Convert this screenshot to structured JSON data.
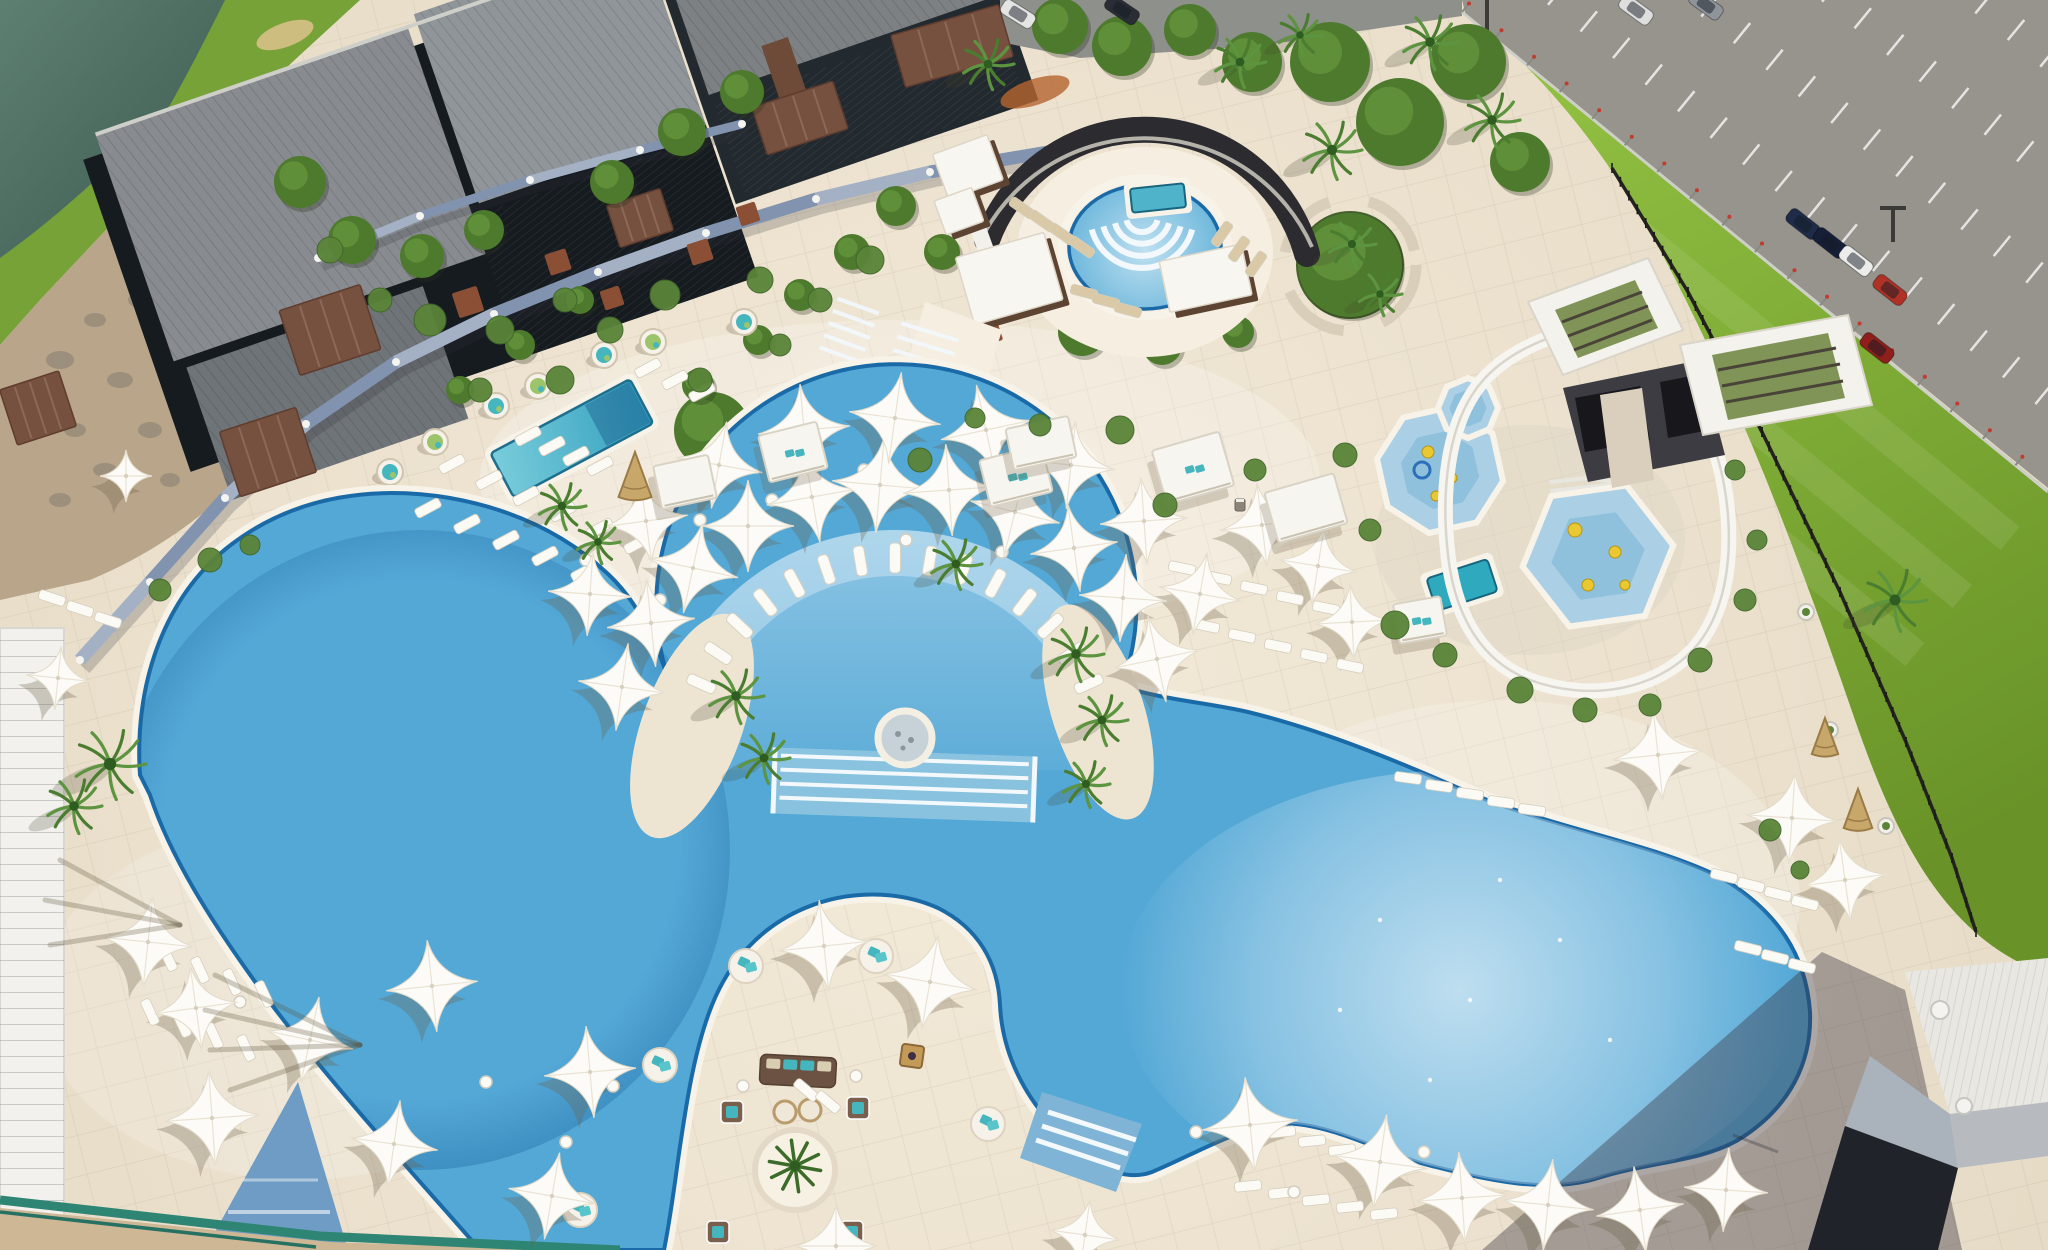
{
  "scene": {
    "title": "Aerial view of a resort pool complex with free-form swimming pools, white star shade umbrellas, water slide, splash pads, lawn and parking lot",
    "width": 2048,
    "height": 1250
  },
  "palette": {
    "deck": "#eee4d2",
    "deck_light": "#f6eee0",
    "water_base": "#54a8d6",
    "water_fan": "#a9d4ec",
    "water_shelf": "#bfe0ef",
    "pool_tile": "#1a6aa8",
    "coping": "#f8f3e8",
    "lake1": "#5d7f72",
    "lake2": "#39544a",
    "grass1": "#93c243",
    "grass2": "#699328",
    "parking_gray": "#96948d",
    "road_gray": "#8e908c",
    "roof1": "#888c90",
    "roof2": "#6f7478",
    "roof3": "#90959a",
    "glass": "#161b20",
    "wood": "#77513f",
    "fence_slate": "#8193af",
    "slide": "#f6f5f0",
    "tower_dark": "#3c3c42",
    "umbrella": "#fcfbf7",
    "umbrella_shadow": "rgba(110,96,72,0.30)",
    "lounger_white": "#fbfaf5",
    "lounger_tan": "#d9c9a7",
    "teal": "#45b6bd",
    "cushion_green": "#9cc46a",
    "pod_white": "#f6f2ea",
    "rust": "#8a4f35",
    "palm": "#4a7d2f",
    "palm_dark": "#2f5c20",
    "tree": "#4e7a2e",
    "shrub": "#5a8438",
    "rock": "#998e7b",
    "sand": "#cdb795",
    "rail_green": "#2f8573",
    "building_white": "#f2f1ed",
    "bldg_roof": "#e9e7e2",
    "bldg_dark": "#20242a",
    "shadow": "rgba(58,52,66,0.40)",
    "step_white": "#f2f8fb",
    "spa_inner": "#c6d2d8",
    "wicker": "#c8a76b",
    "fire": "#c49a58",
    "sofa": "#6b5243"
  },
  "umbrellas": [
    [
      622,
      687,
      44,
      8
    ],
    [
      651,
      623,
      44,
      -6
    ],
    [
      693,
      568,
      46,
      12
    ],
    [
      748,
      526,
      46,
      0
    ],
    [
      812,
      497,
      46,
      -10
    ],
    [
      880,
      485,
      48,
      5
    ],
    [
      949,
      490,
      46,
      -4
    ],
    [
      1015,
      512,
      46,
      14
    ],
    [
      1074,
      548,
      44,
      -8
    ],
    [
      1123,
      598,
      44,
      4
    ],
    [
      1157,
      659,
      44,
      -12
    ],
    [
      590,
      594,
      42,
      4
    ],
    [
      646,
      521,
      42,
      -8
    ],
    [
      719,
      465,
      44,
      10
    ],
    [
      804,
      430,
      46,
      -5
    ],
    [
      895,
      418,
      46,
      8
    ],
    [
      986,
      430,
      46,
      -12
    ],
    [
      1071,
      465,
      44,
      6
    ],
    [
      1144,
      521,
      44,
      -4
    ],
    [
      1200,
      594,
      42,
      10
    ],
    [
      1262,
      525,
      42,
      -7
    ],
    [
      1318,
      566,
      40,
      9
    ],
    [
      1352,
      622,
      38,
      -3
    ],
    [
      126,
      476,
      26,
      0
    ],
    [
      58,
      678,
      32,
      6
    ],
    [
      148,
      942,
      46,
      6
    ],
    [
      196,
      1008,
      42,
      -8
    ],
    [
      212,
      1118,
      48,
      -4
    ],
    [
      310,
      1040,
      44,
      12
    ],
    [
      432,
      986,
      46,
      -6
    ],
    [
      394,
      1144,
      44,
      8
    ],
    [
      590,
      1072,
      46,
      -5
    ],
    [
      552,
      1196,
      44,
      10
    ],
    [
      824,
      946,
      46,
      -6
    ],
    [
      930,
      982,
      48,
      10
    ],
    [
      836,
      1246,
      42,
      0
    ],
    [
      1085,
      1235,
      36,
      8
    ],
    [
      1250,
      1125,
      48,
      -6
    ],
    [
      1380,
      1162,
      48,
      8
    ],
    [
      1462,
      1198,
      46,
      -4
    ],
    [
      1548,
      1205,
      46,
      6
    ],
    [
      1640,
      1210,
      44,
      -8
    ],
    [
      1726,
      1190,
      42,
      4
    ],
    [
      1658,
      755,
      46,
      -6
    ],
    [
      1792,
      818,
      46,
      4
    ],
    [
      1845,
      880,
      42,
      -8
    ]
  ],
  "fan": {
    "cx": 895,
    "cy": 770,
    "r": 212,
    "a0": 204,
    "a1": 336,
    "n": 15
  },
  "lounger_rows": [
    [
      452,
      464,
      6,
      37,
      16,
      -28,
      "w"
    ],
    [
      428,
      508,
      5,
      39,
      16,
      -28,
      "w"
    ],
    [
      528,
      436,
      4,
      24,
      10,
      -28,
      "w"
    ],
    [
      648,
      368,
      3,
      27,
      12,
      -28,
      "w"
    ],
    [
      1022,
      208,
      4,
      20,
      13,
      35,
      "t"
    ],
    [
      1222,
      234,
      3,
      17,
      15,
      -55,
      "t"
    ],
    [
      1084,
      292,
      3,
      22,
      9,
      15,
      "t"
    ],
    [
      1182,
      568,
      5,
      36,
      10,
      12,
      "w"
    ],
    [
      1206,
      626,
      5,
      36,
      10,
      12,
      "w"
    ],
    [
      1724,
      876,
      4,
      27,
      9,
      14,
      "w"
    ],
    [
      1748,
      948,
      3,
      27,
      9,
      14,
      "w"
    ],
    [
      1408,
      778,
      5,
      31,
      8,
      8,
      "w"
    ],
    [
      1248,
      1186,
      5,
      34,
      7,
      -6,
      "w"
    ],
    [
      1282,
      1132,
      3,
      30,
      9,
      -6,
      "w"
    ],
    [
      168,
      958,
      4,
      32,
      12,
      65,
      "w"
    ],
    [
      150,
      1012,
      4,
      32,
      12,
      65,
      "w"
    ],
    [
      52,
      598,
      3,
      28,
      11,
      18,
      "w"
    ],
    [
      806,
      1090,
      2,
      22,
      12,
      40,
      "w"
    ]
  ],
  "pods": [
    [
      390,
      472,
      "t"
    ],
    [
      435,
      442,
      "g"
    ],
    [
      496,
      406,
      "t"
    ],
    [
      538,
      386,
      "g"
    ],
    [
      604,
      355,
      "t"
    ],
    [
      653,
      342,
      "g"
    ],
    [
      744,
      322,
      "t"
    ]
  ],
  "round_beds": [
    [
      660,
      1065
    ],
    [
      988,
      1124
    ],
    [
      580,
      1210
    ],
    [
      746,
      966
    ],
    [
      876,
      956
    ]
  ],
  "armchairs": [
    [
      732,
      1112
    ],
    [
      858,
      1108
    ],
    [
      718,
      1232
    ],
    [
      852,
      1232
    ]
  ],
  "cabanas": [
    [
      685,
      482,
      56,
      44,
      -12,
      0
    ],
    [
      793,
      452,
      60,
      48,
      -14,
      1
    ],
    [
      1016,
      476,
      64,
      48,
      -14,
      1
    ],
    [
      1193,
      468,
      70,
      56,
      -16,
      1
    ],
    [
      1306,
      508,
      72,
      52,
      -16,
      0
    ],
    [
      1041,
      443,
      64,
      42,
      -12,
      0
    ],
    [
      1420,
      620,
      48,
      40,
      -10,
      1
    ]
  ],
  "wood_cabanas": [
    [
      975,
      172,
      58,
      48,
      -20
    ],
    [
      966,
      216,
      40,
      36,
      -20
    ],
    [
      1016,
      284,
      92,
      70,
      -16
    ],
    [
      1212,
      284,
      84,
      52,
      -12
    ]
  ],
  "pergolas": [
    [
      330,
      330,
      85,
      68,
      -18
    ],
    [
      268,
      452,
      80,
      68,
      -18
    ],
    [
      38,
      408,
      62,
      58,
      -18
    ],
    [
      800,
      118,
      85,
      50,
      -18
    ],
    [
      952,
      46,
      112,
      54,
      -16
    ],
    [
      640,
      218,
      56,
      44,
      -18
    ]
  ],
  "planters": [
    [
      468,
      302,
      26,
      -18
    ],
    [
      558,
      262,
      22,
      -18
    ],
    [
      612,
      298,
      20,
      -18
    ],
    [
      700,
      252,
      22,
      -18
    ],
    [
      748,
      214,
      20,
      -18
    ],
    [
      988,
      332,
      24,
      -18
    ]
  ],
  "teepees": [
    [
      635,
      482,
      30
    ],
    [
      1825,
      742,
      24
    ],
    [
      1858,
      815,
      26
    ]
  ],
  "palms": [
    [
      988,
      64,
      26
    ],
    [
      1240,
      62,
      26
    ],
    [
      1300,
      35,
      22
    ],
    [
      1332,
      150,
      30
    ],
    [
      1430,
      42,
      28
    ],
    [
      1492,
      120,
      28
    ],
    [
      1352,
      244,
      24
    ],
    [
      1380,
      294,
      22
    ],
    [
      1895,
      600,
      32
    ],
    [
      110,
      764,
      36
    ],
    [
      74,
      806,
      28
    ],
    [
      736,
      696,
      28
    ],
    [
      764,
      758,
      26
    ],
    [
      1076,
      654,
      28
    ],
    [
      1102,
      720,
      26
    ],
    [
      1086,
      784,
      24
    ],
    [
      956,
      564,
      26
    ],
    [
      562,
      506,
      24
    ],
    [
      598,
      542,
      22
    ]
  ],
  "trees": [
    [
      1330,
      62,
      40
    ],
    [
      1400,
      122,
      44
    ],
    [
      1468,
      62,
      38
    ],
    [
      1520,
      162,
      30
    ],
    [
      1350,
      265,
      52
    ],
    [
      1060,
      26,
      28
    ],
    [
      1122,
      46,
      30
    ],
    [
      1190,
      30,
      26
    ],
    [
      1252,
      62,
      30
    ],
    [
      300,
      182,
      26
    ],
    [
      352,
      240,
      24
    ],
    [
      422,
      256,
      22
    ],
    [
      484,
      230,
      20
    ],
    [
      612,
      182,
      22
    ],
    [
      682,
      132,
      24
    ],
    [
      742,
      92,
      22
    ],
    [
      896,
      206,
      20
    ],
    [
      942,
      252,
      18
    ],
    [
      712,
      430,
      38
    ],
    [
      1082,
      332,
      24
    ],
    [
      1162,
      345,
      20
    ],
    [
      1238,
      332,
      16
    ],
    [
      852,
      252,
      18
    ],
    [
      800,
      295,
      16
    ],
    [
      758,
      340,
      15
    ],
    [
      698,
      385,
      16
    ],
    [
      580,
      300,
      14
    ],
    [
      520,
      345,
      15
    ],
    [
      460,
      390,
      14
    ]
  ],
  "shrubs": [
    [
      430,
      320,
      16
    ],
    [
      500,
      330,
      14
    ],
    [
      565,
      300,
      12
    ],
    [
      610,
      330,
      13
    ],
    [
      665,
      295,
      15
    ],
    [
      760,
      280,
      13
    ],
    [
      820,
      300,
      12
    ],
    [
      870,
      260,
      14
    ],
    [
      780,
      345,
      11
    ],
    [
      700,
      380,
      12
    ],
    [
      560,
      380,
      14
    ],
    [
      480,
      390,
      12
    ],
    [
      1120,
      430,
      14
    ],
    [
      1165,
      505,
      12
    ],
    [
      1255,
      470,
      11
    ],
    [
      1345,
      455,
      12
    ],
    [
      1370,
      530,
      11
    ],
    [
      1395,
      625,
      14
    ],
    [
      1445,
      655,
      12
    ],
    [
      1520,
      690,
      13
    ],
    [
      1585,
      710,
      12
    ],
    [
      1650,
      705,
      11
    ],
    [
      1700,
      660,
      12
    ],
    [
      1745,
      600,
      11
    ],
    [
      1757,
      540,
      10
    ],
    [
      1735,
      470,
      10
    ],
    [
      1770,
      830,
      11
    ],
    [
      1800,
      870,
      9
    ],
    [
      920,
      460,
      12
    ],
    [
      1040,
      425,
      11
    ],
    [
      975,
      418,
      10
    ],
    [
      210,
      560,
      12
    ],
    [
      160,
      590,
      11
    ],
    [
      250,
      545,
      10
    ],
    [
      330,
      250,
      13
    ],
    [
      380,
      300,
      12
    ]
  ],
  "rocks": [
    [
      60,
      360,
      14,
      9
    ],
    [
      95,
      320,
      11,
      7
    ],
    [
      140,
      300,
      12,
      8
    ],
    [
      180,
      340,
      10,
      7
    ],
    [
      120,
      380,
      13,
      8
    ],
    [
      75,
      430,
      11,
      7
    ],
    [
      150,
      430,
      12,
      8
    ],
    [
      200,
      395,
      10,
      6
    ],
    [
      105,
      470,
      12,
      7
    ],
    [
      170,
      480,
      10,
      7
    ],
    [
      60,
      500,
      11,
      7
    ],
    [
      220,
      440,
      9,
      6
    ]
  ],
  "tables": [
    [
      700,
      520
    ],
    [
      772,
      500
    ],
    [
      864,
      470
    ],
    [
      948,
      470
    ],
    [
      1040,
      488
    ],
    [
      1122,
      520
    ],
    [
      906,
      540
    ],
    [
      1002,
      552
    ],
    [
      660,
      600
    ],
    [
      586,
      560
    ],
    [
      240,
      1002
    ],
    [
      214,
      1098
    ],
    [
      486,
      1082
    ],
    [
      566,
      1142
    ],
    [
      1196,
      1132
    ],
    [
      1294,
      1192
    ],
    [
      1424,
      1152
    ],
    [
      743,
      1086
    ],
    [
      856,
      1076
    ],
    [
      613,
      1086
    ]
  ],
  "cars": [
    [
      1018,
      14,
      32,
      "#e4e4e2"
    ],
    [
      1122,
      10,
      34,
      "#2a2d33"
    ],
    [
      1636,
      10,
      36,
      "#dedede"
    ],
    [
      1706,
      5,
      36,
      "#8f949a"
    ],
    [
      1803,
      224,
      38,
      "#1f2c49"
    ],
    [
      1830,
      243,
      38,
      "#151f38"
    ],
    [
      1856,
      261,
      38,
      "#ececea"
    ],
    [
      1890,
      290,
      38,
      "#b03226"
    ],
    [
      1877,
      348,
      38,
      "#8e1f1a"
    ]
  ],
  "pots": [
    [
      1806,
      612
    ],
    [
      1830,
      730
    ],
    [
      1886,
      826
    ]
  ],
  "bins": [
    [
      1240,
      505
    ],
    [
      1253,
      520
    ]
  ],
  "glints": [
    [
      1380,
      920
    ],
    [
      1470,
      1000
    ],
    [
      1560,
      940
    ],
    [
      1430,
      1080
    ],
    [
      1610,
      1040
    ],
    [
      1500,
      880
    ],
    [
      1340,
      1010
    ]
  ],
  "steps": [
    [
      930,
      332,
      5,
      60,
      17,
      14
    ],
    [
      858,
      306,
      5,
      44,
      20,
      13
    ],
    [
      1008,
      484,
      4,
      52,
      16,
      12
    ],
    [
      1614,
      404,
      8,
      40,
      8,
      11
    ],
    [
      1588,
      478,
      3,
      78,
      -6,
      9
    ]
  ],
  "pads": [
    [
      1440,
      470,
      64,
      8,
      10
    ],
    [
      1468,
      408,
      30,
      8,
      0
    ],
    [
      1598,
      556,
      76,
      6,
      -8
    ]
  ],
  "pad_toys": [
    [
      1428,
      452,
      6
    ],
    [
      1452,
      478,
      5
    ],
    [
      1436,
      496,
      5
    ],
    [
      1575,
      530,
      7
    ],
    [
      1615,
      552,
      6
    ],
    [
      1588,
      585,
      6
    ],
    [
      1625,
      585,
      5
    ]
  ],
  "fences": {
    "garden": [
      [
        80,
        660
      ],
      [
        150,
        582
      ],
      [
        225,
        498
      ],
      [
        306,
        424
      ],
      [
        396,
        362
      ],
      [
        494,
        314
      ],
      [
        598,
        272
      ],
      [
        706,
        233
      ],
      [
        816,
        199
      ],
      [
        930,
        172
      ],
      [
        1048,
        152
      ]
    ],
    "garden_upper": [
      [
        318,
        258
      ],
      [
        420,
        216
      ],
      [
        530,
        180
      ],
      [
        640,
        150
      ],
      [
        742,
        124
      ]
    ],
    "black": [
      [
        1612,
        168
      ],
      [
        1688,
        292
      ],
      [
        1762,
        432
      ],
      [
        1840,
        592
      ],
      [
        1906,
        742
      ],
      [
        1952,
        858
      ],
      [
        1976,
        932
      ]
    ],
    "silver": {
      "ax": 1462,
      "ay": 12,
      "bx": 2048,
      "by": 492,
      "posts": 19
    }
  },
  "parking": {
    "rows": 5,
    "row_gap": 88,
    "row_offset": 60,
    "dash_step": 42,
    "dash_len": 26
  },
  "lawn_stripes": 3
}
